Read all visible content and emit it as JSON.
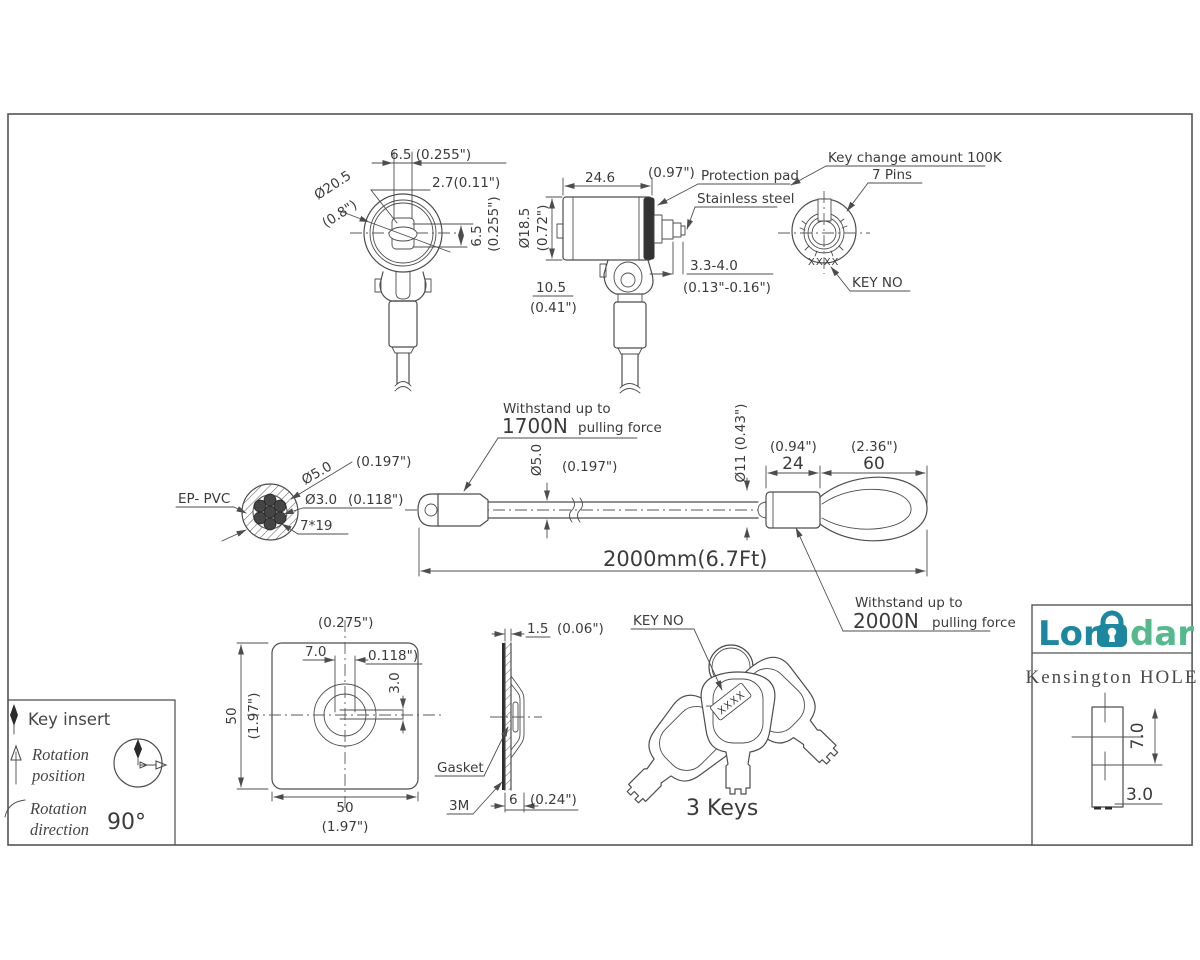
{
  "drawing": {
    "front": {
      "d65": "6.5 (0.255\")",
      "d27": "2.7(0.11\")",
      "dia": "Ø20.5",
      "dia_in": "(0.8\")",
      "r65": "6.5",
      "r65_in": "(0.255\")"
    },
    "side": {
      "d246": "24.6",
      "d246_in": "(0.97\")",
      "pad": "Protection pad",
      "steel": "Stainless steel",
      "dia185": "Ø18.5",
      "dia185_in": "(0.72\")",
      "d105": "10.5",
      "d105_in": "(0.41\")",
      "d334": "3.3-4.0",
      "d334_in": "(0.13\"-0.16\")"
    },
    "face": {
      "keychange": "Key change amount 100K",
      "pins": "7 Pins",
      "keyno": "KEY NO",
      "xxxx": "XXXX"
    },
    "cross": {
      "ep": "EP- PVC",
      "dia50": "Ø5.0",
      "dia50_in": "(0.197\")",
      "dia30": "Ø3.0",
      "dia30_in": "(0.118\")",
      "strand": "7*19"
    },
    "cable": {
      "w1": "Withstand up to",
      "f1": "1700N",
      "p1": "pulling force",
      "dia50": "Ø5.0",
      "dia50_in": "(0.197\")",
      "dia11": "Ø11 (0.43\")",
      "d24": "24",
      "d24_in": "(0.94\")",
      "d60": "60",
      "d60_in": "(2.36\")",
      "len": "2000mm(6.7Ft)",
      "w2": "Withstand up to",
      "f2": "2000N",
      "p2": "pulling force"
    },
    "legend": {
      "insert": "Key insert",
      "rot1a": "Rotation",
      "rot1b": "position",
      "rot2a": "Rotation",
      "rot2b": "direction",
      "angle": "90°"
    },
    "plate": {
      "t_in": "(0.275\")",
      "d70": "7.0",
      "d0118": "0.118\")",
      "d30": "3.0",
      "l50": "50",
      "l_in": "(1.97\")",
      "b50": "50",
      "b_in": "(1.97\")"
    },
    "gasket": {
      "d15": "1.5",
      "d15_in": "(0.06\")",
      "name": "Gasket",
      "m3": "3M",
      "d6": "6",
      "d6_in": "(0.24\")"
    },
    "keys": {
      "keyno": "KEY NO",
      "xxxx": "XXXX",
      "count": "3 Keys"
    },
    "brand": {
      "lor": "Lor",
      "dar": "dar",
      "product": "Kensington HOLE",
      "d70": "7.0",
      "d30": "3.0",
      "teal": "#1d87a0",
      "green": "#55b98c"
    }
  }
}
